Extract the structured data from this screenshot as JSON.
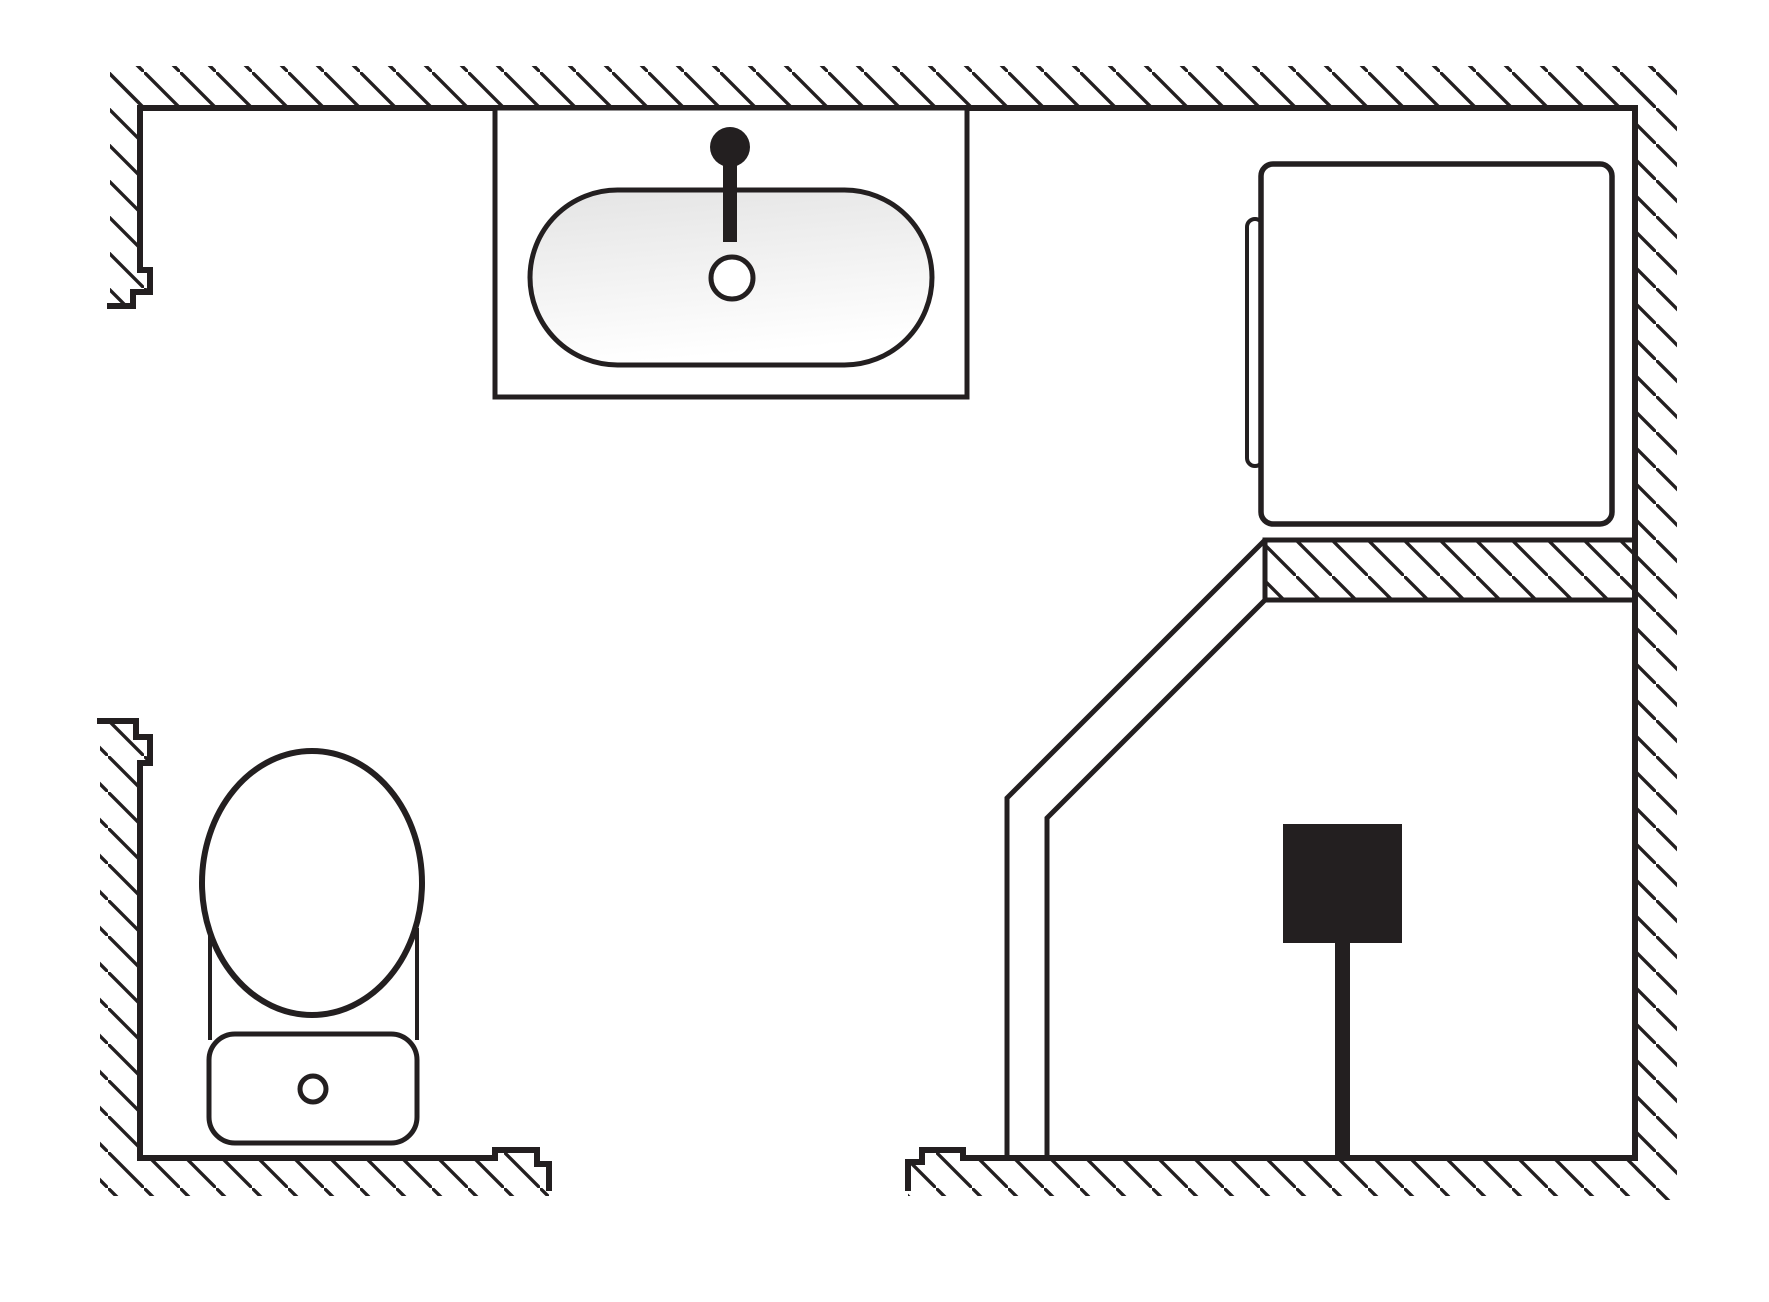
{
  "document": {
    "kind": "architectural-floor-plan",
    "room": "bathroom-plan-view"
  },
  "drawing": {
    "canvas": {
      "width": 1769,
      "height": 1302
    },
    "style": {
      "line_color": "#231f20",
      "white": "#ffffff",
      "basin_top": "#e4e4e4",
      "basin_bottom": "#ffffff",
      "hatch_spacing": 36,
      "hatch_stroke": 3.4,
      "face_stroke": 6,
      "fixture_stroke": 5
    },
    "wall_hatch_polygons": [
      {
        "name": "wall-top-hatch",
        "points": "110,66 1677,66 1677,108 110,108"
      },
      {
        "name": "wall-right-hatch",
        "points": "1635,66 1677,66 1677,1200 1635,1200"
      },
      {
        "name": "wall-upper-left-hatch",
        "points": "110,66 140,66 140,270 150,270 150,292 133,292 133,306 110,306"
      },
      {
        "name": "wall-lower-left-hatch",
        "points": "100,721 136,721 136,737 150,737 150,763 140,763 140,1158 100,1158"
      },
      {
        "name": "wall-bottom-left-hatch",
        "points": "100,1158 495,1158 495,1150 537,1150 537,1164 549,1164 549,1196 100,1196"
      },
      {
        "name": "wall-bottom-right-hatch",
        "points": "908,1162 922,1162 922,1150 963,1150 963,1158 1640,1158 1640,1196 908,1196"
      }
    ],
    "partition": {
      "name": "shower-partition-wall",
      "points": "1265,540 1635,540 1635,600 1265,600",
      "stroke_width": 5
    },
    "wall_faces": [
      {
        "name": "wall-face-top",
        "points": "140,108 1635,108"
      },
      {
        "name": "wall-face-right",
        "points": "1635,108 1635,1158"
      },
      {
        "name": "wall-face-upper-left",
        "points": "140,108 140,270 150,270 150,292 133,292 133,306 110,306"
      },
      {
        "name": "wall-face-lower-left",
        "points": "100,721 136,721 136,737 150,737 150,763 140,763 140,1158"
      },
      {
        "name": "wall-face-bottom-left",
        "points": "140,1158 495,1158 495,1150 537,1150 537,1164 549,1164 549,1188"
      },
      {
        "name": "wall-face-bottom-right",
        "points": "908,1188 908,1162 922,1162 922,1150 963,1150 963,1158 1635,1158"
      }
    ],
    "fixtures": [
      {
        "name": "sink-counter",
        "type": "rect",
        "x": 495,
        "y": 108,
        "w": 472,
        "h": 289,
        "rx": 0,
        "fill": "white",
        "sw": 5
      },
      {
        "name": "sink-basin",
        "type": "rect",
        "x": 530,
        "y": 190,
        "w": 402,
        "h": 175,
        "rx": 87.5,
        "fill": "basin-gradient",
        "sw": 5
      },
      {
        "name": "faucet-stem",
        "type": "rect",
        "x": 723,
        "y": 150,
        "w": 14,
        "h": 92,
        "rx": 0,
        "fill": "black",
        "sw": 0
      },
      {
        "name": "faucet-knob",
        "type": "circle",
        "cx": 730,
        "cy": 147,
        "r": 20,
        "fill": "black",
        "sw": 0
      },
      {
        "name": "sink-drain",
        "type": "circle",
        "cx": 732,
        "cy": 278,
        "r": 21,
        "fill": "white",
        "sw": 5
      },
      {
        "name": "washer-door-handle",
        "type": "rect",
        "x": 1247,
        "y": 219,
        "w": 16,
        "h": 247,
        "rx": 8,
        "fill": "white",
        "sw": 4
      },
      {
        "name": "washing-machine",
        "type": "rect",
        "x": 1261,
        "y": 164,
        "w": 351,
        "h": 360,
        "rx": 12,
        "fill": "white",
        "sw": 5.5
      },
      {
        "name": "toilet-body-left-edge",
        "type": "line",
        "x1": 210,
        "y1": 928,
        "x2": 210,
        "y2": 1040,
        "sw": 4
      },
      {
        "name": "toilet-body-right-edge",
        "type": "line",
        "x1": 417,
        "y1": 928,
        "x2": 417,
        "y2": 1040,
        "sw": 4
      },
      {
        "name": "toilet-tank",
        "type": "rect",
        "x": 209,
        "y": 1034,
        "w": 208,
        "h": 109,
        "rx": 26,
        "fill": "white",
        "sw": 5
      },
      {
        "name": "toilet-bowl",
        "type": "ellipse",
        "cx": 312,
        "cy": 883,
        "rx": 110,
        "ry": 132,
        "fill": "white",
        "sw": 6
      },
      {
        "name": "toilet-flush-button",
        "type": "circle",
        "cx": 313,
        "cy": 1089,
        "r": 13,
        "fill": "white",
        "sw": 5
      },
      {
        "name": "shower-glass-outer",
        "type": "polyline",
        "points": "1265,540 1007,798 1007,1158",
        "sw": 5
      },
      {
        "name": "shower-glass-inner",
        "type": "polyline",
        "points": "1265,600 1047,818 1047,1158",
        "sw": 5
      },
      {
        "name": "shower-head",
        "type": "rect",
        "x": 1283,
        "y": 824,
        "w": 119,
        "h": 119,
        "rx": 0,
        "fill": "black",
        "sw": 0
      },
      {
        "name": "shower-arm",
        "type": "rect",
        "x": 1335,
        "y": 943,
        "w": 15,
        "h": 215,
        "rx": 0,
        "fill": "black",
        "sw": 0
      }
    ]
  }
}
